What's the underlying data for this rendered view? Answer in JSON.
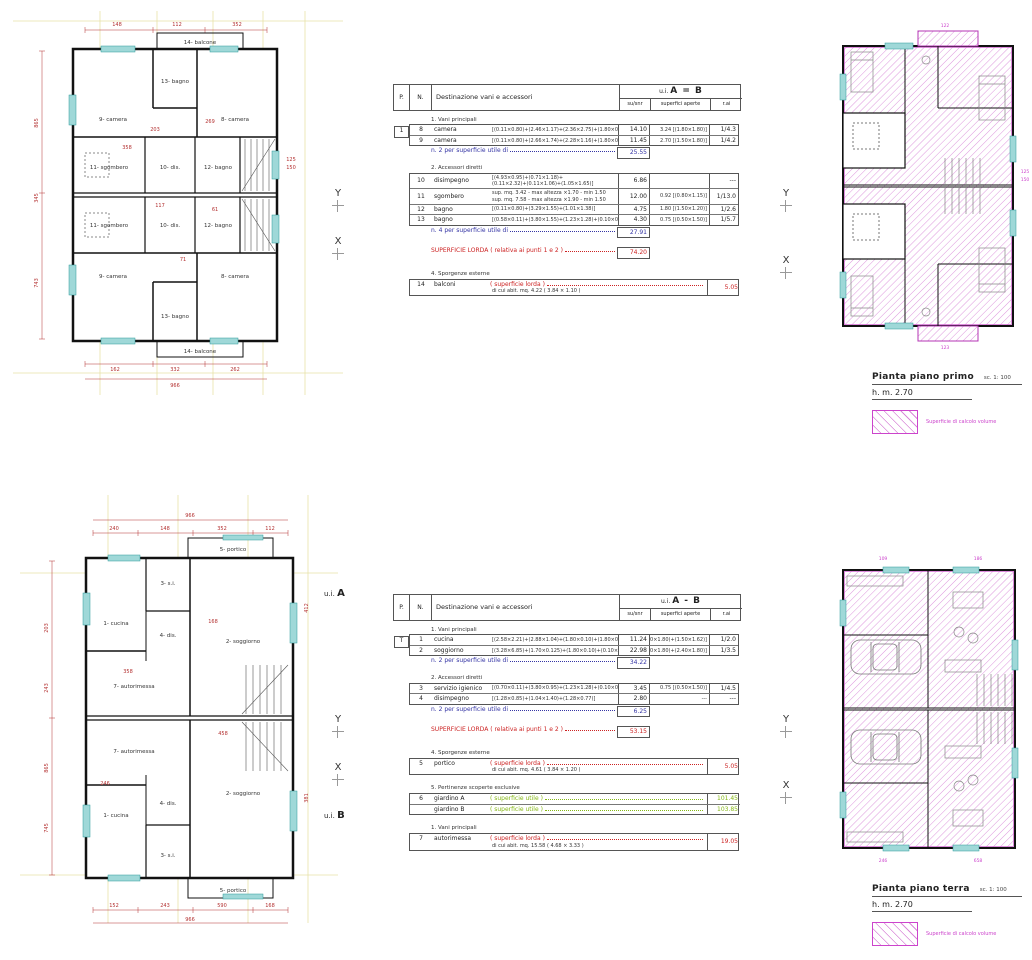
{
  "colors": {
    "wall": "#111111",
    "dim_red": "#b33030",
    "subtotal_blue": "#3535a5",
    "total_red": "#cc2222",
    "garden_green": "#86b817",
    "hatch_magenta": "#cc44cc",
    "window_cyan": "#9fd8d8",
    "construction_yellow": "#e8e2a8"
  },
  "markers": {
    "ui": "u.i.",
    "a": "A",
    "b": "B",
    "x": "X",
    "y": "Y"
  },
  "captions": {
    "first": {
      "title": "Pianta piano primo",
      "scale": "sc. 1: 100",
      "height": "h. m. 2.70",
      "legend": "Superficie di calcolo volume"
    },
    "ground": {
      "title": "Pianta piano terra",
      "scale": "sc. 1: 100",
      "height": "h. m. 2.70",
      "legend": "Superficie di calcolo volume"
    }
  },
  "tables": [
    {
      "header": {
        "p": "P.",
        "n": "N.",
        "dest": "Destinazione vani e accessori",
        "ui": "u.i.",
        "ui_units": "A = B",
        "su": "su/snr",
        "aperte": "superfici aperte",
        "rai": "r.ai"
      },
      "rows": [
        {
          "group": "1. Vani principali"
        },
        {
          "p": "1",
          "n": "8",
          "name": "camera",
          "formula": "[(0.11×0.80)+(2.46×1.17)+(2.36×2.75)+(1.80×0.16)]",
          "su": "14.10",
          "aperte": "3.24  [(1.80×1.80)]",
          "rai": "1/4.3"
        },
        {
          "n": "9",
          "name": "camera",
          "formula": "[(0.11×0.80)+(2.66×1.74)+(2.28×1.16)+(1.80×0.16)]",
          "su": "11.45",
          "aperte": "2.70  [(1.50×1.80)]",
          "rai": "1/4.2"
        },
        {
          "subtotal": "n. 2 per superficie utile di",
          "value": "25.55"
        },
        {
          "group": "2. Accessori diretti"
        },
        {
          "n": "10",
          "name": "disimpegno",
          "formula": "[(4.93×0.95)+(0.71×1.18)+",
          "formula2": "(0.11×2.32)+(0.11×1.06)+(1.05×1.65)]",
          "su": "6.86",
          "aperte": "",
          "rai": "---"
        },
        {
          "n": "11",
          "name": "sgombero",
          "formula": "sup. mq. 3.42  -  max altezza ×1.70 - min 1.50",
          "formula2": "sup. mq. 7.58  -  max altezza ×1.90 - min 1.50",
          "su": "12.00",
          "aperte": "0.92  [(0.80×1.15)]",
          "rai": "1/13.0"
        },
        {
          "n": "12",
          "name": "bagno",
          "formula": "[(0.11×0.80)+(3.29×1.55)+(1.01×1.38)]",
          "su": "4.75",
          "aperte": "1.80  [(1.50×1.20)]",
          "rai": "1/2.6"
        },
        {
          "n": "13",
          "name": "bagno",
          "formula": "[(0.58×0.11)+(3.80×1.55)+(1.23×1.28)+(0.10×0.80)]",
          "su": "4.30",
          "aperte": "0.75  [(0.50×1.50)]",
          "rai": "1/5.7"
        },
        {
          "subtotal": "n. 4 per superficie utile di",
          "value": "27.91"
        },
        {
          "lorda": "SUPERFICIE LORDA  ( relativa ai punti 1 e 2 )",
          "value": "74.20"
        },
        {
          "group": "4. Sporgenze esterne"
        },
        {
          "n": "14",
          "name": "balconi",
          "formula": "( superficie lorda )",
          "note": "di cui abit. mq. 4.22   ( 3.84 × 1.10 )",
          "su": "5.05"
        }
      ]
    },
    {
      "header": {
        "p": "P.",
        "n": "N.",
        "dest": "Destinazione vani e accessori",
        "ui": "u.i.",
        "ui_units": "A - B",
        "su": "su/snr",
        "aperte": "superfici aperte",
        "rai": "r.ai"
      },
      "rows": [
        {
          "group": "1. Vani principali"
        },
        {
          "p": "T",
          "n": "1",
          "name": "cucina",
          "formula": "[(2.58×2.21)+(2.88×1.04)+(1.80×0.10)+(1.80×0.10)]",
          "su": "11.24",
          "aperte": "5.67  [(1.80×1.80)+(1.50×1.62)]",
          "rai": "1/2.0"
        },
        {
          "n": "2",
          "name": "soggiorno",
          "formula": "[(3.28×6.85)+(1.70×0.125)+(1.80×0.10)+(0.10×2.40)]",
          "su": "22.98",
          "aperte": "7.56  [(1.80×1.80)+(2.40×1.80)]",
          "rai": "1/3.5"
        },
        {
          "subtotal": "n. 2 per superficie utile di",
          "value": "34.22"
        },
        {
          "group": "2. Accessori diretti"
        },
        {
          "n": "3",
          "name": "servizio igienico",
          "formula": "[(0.70×0.11)+(3.80×0.95)+(1.23×1.28)+(0.10×0.52)]",
          "su": "3.45",
          "aperte": "0.75  [(0.50×1.50)]",
          "rai": "1/4.5"
        },
        {
          "n": "4",
          "name": "disimpegno",
          "formula": "[(1.28×0.85)+(1.04×1.40)+(1.28×0.77)]",
          "su": "2.80",
          "aperte": "---",
          "rai": "---"
        },
        {
          "subtotal": "n. 2 per superficie utile di",
          "value": "6.25"
        },
        {
          "lorda": "SUPERFICIE LORDA  ( relativa ai punti 1 e 2 )",
          "value": "53.15"
        },
        {
          "group": "4. Sporgenze esterne"
        },
        {
          "n": "5",
          "name": "portico",
          "formula": "( superficie lorda )",
          "note": "di cui abit. mq. 4.61   ( 3.84 × 1.20 )",
          "su": "5.05"
        },
        {
          "group": "5. Pertinenze scoperte esclusive"
        },
        {
          "n": "6",
          "name": "giardino  A",
          "formula": "( superficie utile )",
          "su": "101.45"
        },
        {
          "name": "giardino  B",
          "formula": "( superficie utile )",
          "su": "103.85"
        },
        {
          "group": "1. Vani principali"
        },
        {
          "n": "7",
          "name": "autorimessa",
          "formula": "( superficie lorda )",
          "note": "di cui abit. mq. 15.58   ( 4.68 × 3.33 )",
          "su": "19.05"
        }
      ]
    }
  ],
  "plans": {
    "ff": {
      "rooms": {
        "balcone": "14- balcone",
        "bagno13": "13- bagno",
        "camera9": "9- camera",
        "camera8": "8- camera",
        "sgombero": "11- sgombero",
        "dis": "10- dis.",
        "bagno12": "12- bagno"
      },
      "dims": {
        "top": [
          "148",
          "112",
          "352"
        ],
        "left": [
          "865",
          "345",
          "743"
        ],
        "right": [
          "125",
          "150"
        ],
        "bottom": [
          "162",
          "332",
          "262"
        ],
        "total": "966",
        "inner": [
          "358",
          "203",
          "269",
          "117",
          "61",
          "71"
        ]
      }
    },
    "gf": {
      "rooms": {
        "portico": "5- portico",
        "si": "3- s.i.",
        "cucina": "1- cucina",
        "dis": "4- dis.",
        "soggiorno": "2- soggiorno",
        "autorimessa": "7- autorimessa"
      },
      "dims": {
        "top": [
          "240",
          "148",
          "352",
          "112"
        ],
        "left": [
          "203",
          "243",
          "865",
          "745"
        ],
        "right": [
          "412",
          "381"
        ],
        "bottom": [
          "152",
          "243",
          "590",
          "168"
        ],
        "total": "966",
        "inner": [
          "358",
          "458",
          "246",
          "168"
        ]
      }
    },
    "calc_ff": [
      "122",
      "123",
      "125",
      "150"
    ],
    "calc_gf": [
      "109",
      "186",
      "246",
      "658"
    ]
  }
}
